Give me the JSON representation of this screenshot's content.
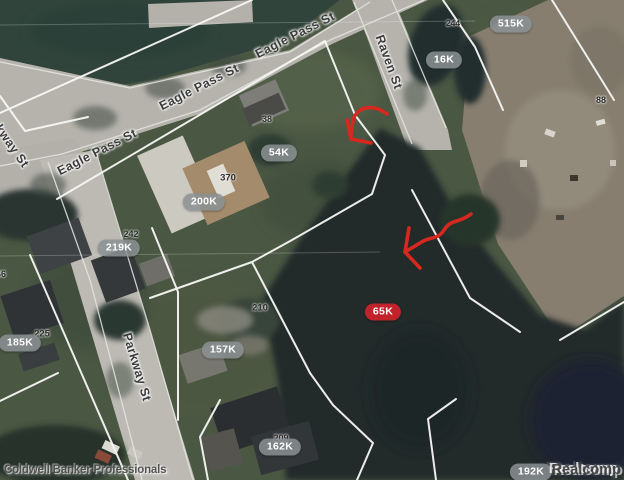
{
  "map": {
    "streets": [
      {
        "name": "eagle-pass-st-lower-left",
        "label": "Eagle Pass St"
      },
      {
        "name": "eagle-pass-st-middle",
        "label": "Eagle Pass St"
      },
      {
        "name": "eagle-pass-st-upper-right",
        "label": "Eagle Pass St"
      },
      {
        "name": "raven-st",
        "label": "Raven St"
      },
      {
        "name": "parkway-st",
        "label": "Parkway St"
      },
      {
        "name": "partial-kway-st",
        "label": "kway St"
      }
    ],
    "price_markers": [
      {
        "label": "515K",
        "style": "gray"
      },
      {
        "label": "16K",
        "style": "gray"
      },
      {
        "label": "54K",
        "style": "gray"
      },
      {
        "label": "200K",
        "style": "gray"
      },
      {
        "label": "219K",
        "style": "gray"
      },
      {
        "label": "185K",
        "style": "gray"
      },
      {
        "label": "157K",
        "style": "gray"
      },
      {
        "label": "65K",
        "style": "red"
      },
      {
        "label": "162K",
        "style": "gray"
      },
      {
        "label": "192K",
        "style": "gray"
      }
    ],
    "house_numbers": [
      "244",
      "88",
      "38",
      "370",
      "242",
      "46",
      "225",
      "210",
      "209"
    ],
    "watermarks": {
      "left": "Coldwell Banker Professionals",
      "right": "Realcomp"
    },
    "colors": {
      "marker_gray": "#8b9093",
      "marker_red": "#c1232b",
      "annotation_red": "#d6281e",
      "parcel_line": "#f7f7f4"
    },
    "annotations": [
      {
        "type": "hand-drawn-arrow",
        "points_to": "lot near 54K"
      },
      {
        "type": "hand-drawn-arrow",
        "points_to": "lot near 65K"
      }
    ]
  }
}
